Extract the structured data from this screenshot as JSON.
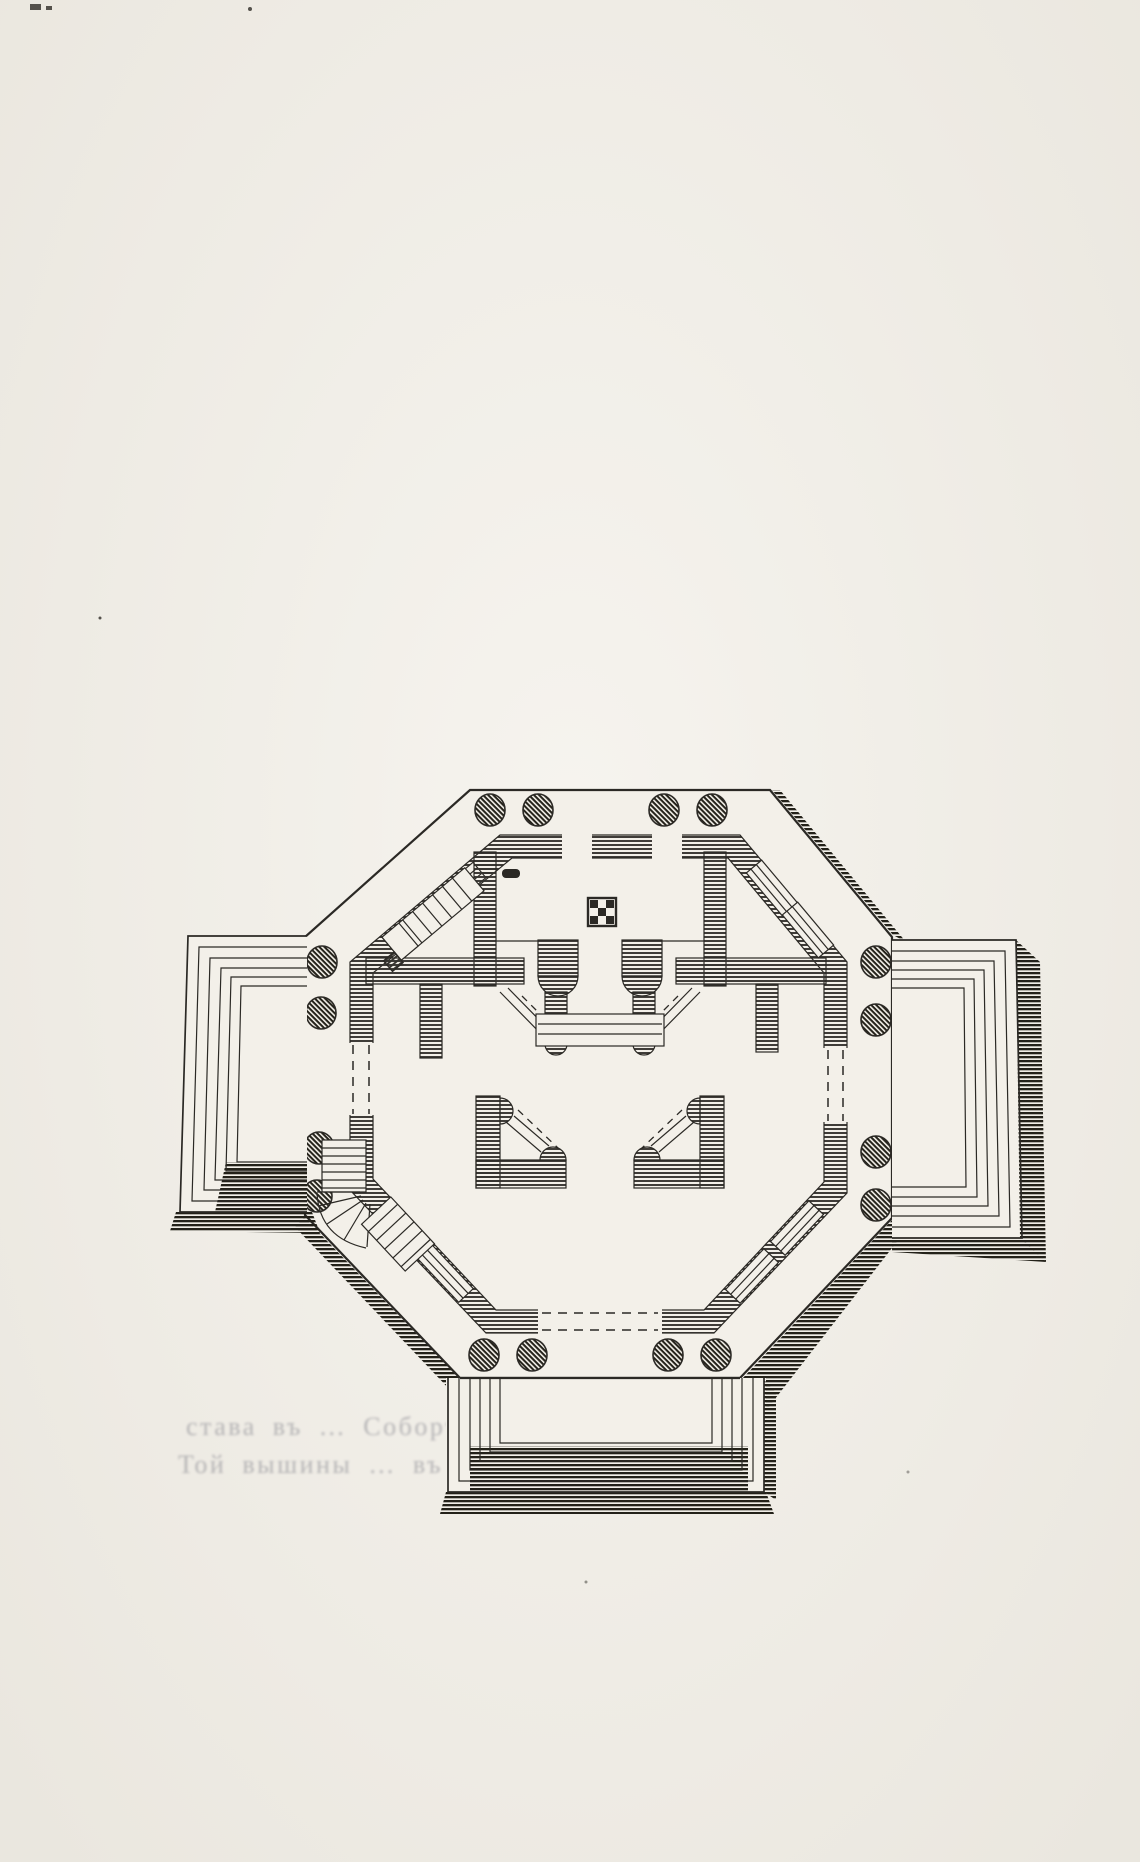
{
  "page": {
    "type": "scanned-book-page",
    "content": "Engraved floor plan of an octagonal domed building: perimeter wall ring with four columned porches (4 columns each), three projecting stepped porticos (left, right, bottom), inner north chamber with checkerboard marker, paired piers with half-round responds and diagonal stair struts, fan staircase at lower-left, dashed door openings on cardinal faces, windows on diagonal faces"
  },
  "palette": {
    "paper": "#f3f0e9",
    "ink": "#2b2925",
    "wall": "#35332e",
    "shadow": "#232119",
    "bleed": "#70717c"
  },
  "figure": {
    "parts": [
      "octagon-platform",
      "perimeter-wall-ring",
      "porch-columns",
      "left-portico-steps",
      "right-portico-steps",
      "bottom-portico-steps",
      "north-chamber",
      "checkerboard-marker",
      "central-piers",
      "south-piers",
      "fan-staircase",
      "straight-staircase",
      "diagonal-windows",
      "door-opening-dashes",
      "cast-shadows"
    ]
  },
  "bleed_through_text": {
    "line1": "става въ … Соборъ оной Величины,",
    "line2": "Той вышины … въ вышинѣ, какъ"
  }
}
